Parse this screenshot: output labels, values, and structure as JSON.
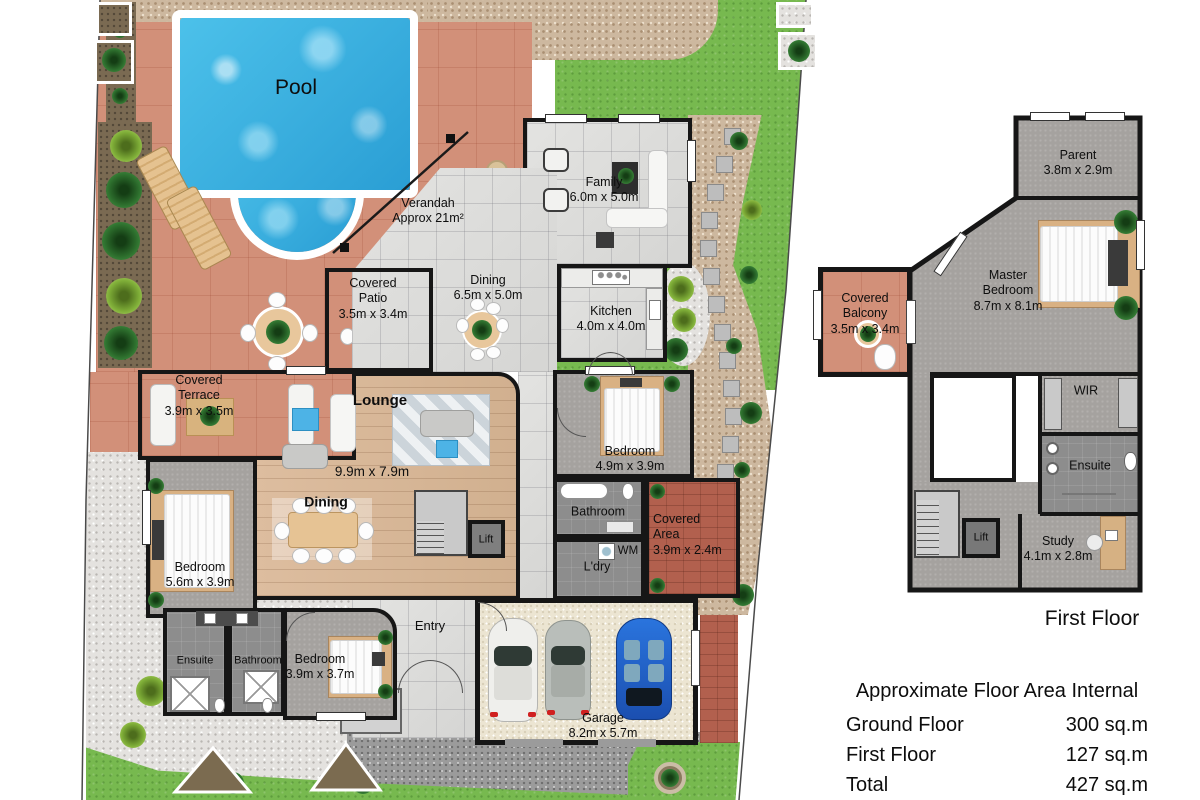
{
  "ground_floor": {
    "pool_label": "Pool",
    "verandah": {
      "name": "Verandah",
      "dims": "Approx 21m²"
    },
    "family": {
      "name": "Family",
      "dims": "6.0m x 5.0m"
    },
    "dining": {
      "name": "Dining",
      "dims": "6.5m x 5.0m"
    },
    "kitchen": {
      "name": "Kitchen",
      "dims": "4.0m x 4.0m"
    },
    "covered_patio": {
      "name": "Covered Patio",
      "dims": "3.5m x 3.4m"
    },
    "covered_terrace": {
      "name": "Covered Terrace",
      "dims": "3.9m x 3.5m"
    },
    "lounge": {
      "name": "Lounge",
      "dims": "9.9m x 7.9m"
    },
    "dining2": {
      "name": "Dining"
    },
    "bedroom_right": {
      "name": "Bedroom",
      "dims": "4.9m x 3.9m"
    },
    "bathroom": {
      "name": "Bathroom"
    },
    "laundry": {
      "name": "L'dry",
      "appliance": "WM"
    },
    "covered_area": {
      "name": "Covered Area",
      "dims": "3.9m x 2.4m"
    },
    "lift": {
      "name": "Lift"
    },
    "entry": {
      "name": "Entry"
    },
    "bedroom_left": {
      "name": "Bedroom",
      "dims": "5.6m x 3.9m"
    },
    "ensuite": {
      "name": "Ensuite"
    },
    "bathroom2": {
      "name": "Bathroom"
    },
    "bedroom_bottom": {
      "name": "Bedroom",
      "dims": "3.9m x 3.7m"
    },
    "garage": {
      "name": "Garage",
      "dims": "8.2m x 5.7m"
    }
  },
  "first_floor": {
    "caption": "First Floor",
    "parent": {
      "name": "Parent",
      "dims": "3.8m x 2.9m"
    },
    "master": {
      "name": "Master Bedroom",
      "dims": "8.7m x 8.1m"
    },
    "covered_balcony": {
      "name": "Covered Balcony",
      "dims": "3.5m x 3.4m"
    },
    "wir": {
      "name": "WIR"
    },
    "ensuite": {
      "name": "Ensuite"
    },
    "lift": {
      "name": "Lift"
    },
    "study": {
      "name": "Study",
      "dims": "4.1m x 2.8m"
    }
  },
  "area_table": {
    "title": "Approximate Floor Area Internal",
    "rows": [
      {
        "label": "Ground Floor",
        "value": "300 sq.m"
      },
      {
        "label": "First Floor",
        "value": "127 sq.m"
      },
      {
        "label": "Total",
        "value": "427 sq.m"
      }
    ]
  },
  "palette": {
    "pool_water": "#35aede",
    "terracotta_paving": "#d29079",
    "lawn_green": "#77b94f",
    "timber_floor": "#d7b698",
    "carpet_grey": "#a5a29f",
    "marble_floor": "#dcdcda",
    "brick_paving": "#b2604e",
    "wall": "#161616"
  }
}
